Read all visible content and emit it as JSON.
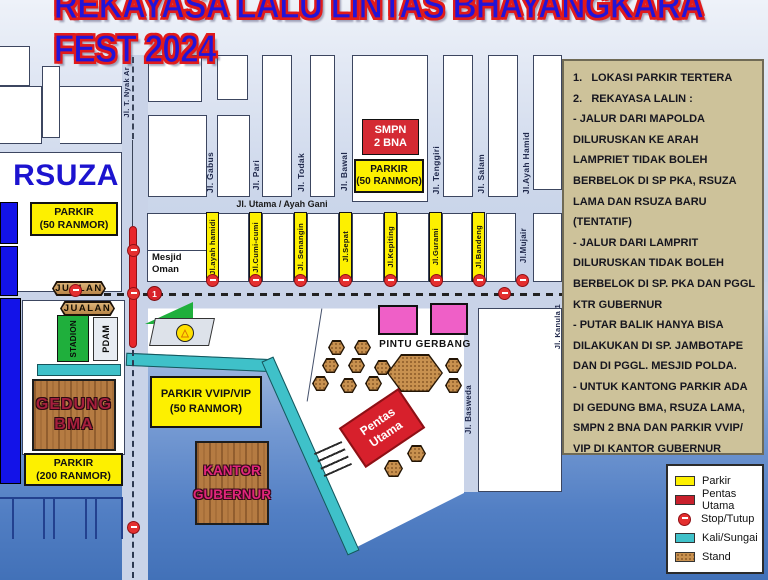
{
  "title": "REKAYASA LALU LINTAS BHAYANGKARA FEST 2024",
  "colors": {
    "title_blue": "#2214d8",
    "title_red": "#e11b1b",
    "parkir_yellow": "#fdf000",
    "pentas_red": "#d7202c",
    "kali_teal": "#3fc1c9",
    "stand_brown": "#c8914f",
    "stop_red": "#e42f2f",
    "gate_pink": "#ef5fc7"
  },
  "notes": {
    "lines": [
      "1.   LOKASI PARKIR TERTERA",
      "2.   REKAYASA LALIN :",
      "- JALUR DARI MAPOLDA",
      "DILURUSKAN KE ARAH",
      "LAMPRIET TIDAK BOLEH",
      "BERBELOK DI SP PKA, RSUZA",
      "LAMA DAN RSUZA BARU",
      "(TENTATIF)",
      "- JALUR DARI LAMPRIT",
      "DILURUSKAN TIDAK BOLEH",
      "BERBELOK DI SP. PKA DAN PGGL",
      "KTR GUBERNUR",
      "- PUTAR BALIK HANYA BISA",
      "DILAKUKAN DI SP. JAMBOTAPE",
      "DAN DI PGGL. MESJID POLDA.",
      "- UNTUK KANTONG PARKIR ADA",
      "DI GEDUNG BMA, RSUZA LAMA,",
      "SMPN 2 BNA DAN PARKIR VVIP/",
      "VIP DI KANTOR GUBERNUR"
    ]
  },
  "legend": {
    "items": [
      {
        "label": "Parkir",
        "swatch": "parkir"
      },
      {
        "label": "Pentas Utama",
        "swatch": "pentas"
      },
      {
        "label": "Stop/Tutup",
        "swatch": "stop"
      },
      {
        "label": "Kali/Sungai",
        "swatch": "kali"
      },
      {
        "label": "Stand",
        "swatch": "stand"
      }
    ]
  },
  "streets": {
    "nyak": "Jl. T. Nyak Ar",
    "gabus": "Jl. Gabus",
    "pari": "Jl. Pari",
    "todak": "Jl. Todak",
    "bawal": "Jl. Bawal",
    "tenggiri": "Jl. Tenggiri",
    "salam": "Jl. Salam",
    "ayah_hamid": "Jl.Ayah Hamid",
    "utama": "Jl. Utama / Ayah Gani",
    "ayah_hamidi": "Jl.ayah hamidi",
    "cumi": "Jl.Cumi-cumi",
    "senangin": "Jl. Senangin",
    "sepat": "Jl.Sepat",
    "kepiting": "Jl.Kepiting",
    "gurami": "Jl.Gurami",
    "bandeng": "Jl.Bandeng",
    "mujair": "Jl.Mujair",
    "basweda": "Jl. Basweda",
    "kanula": "Jl. Kanula 1"
  },
  "places": {
    "rsuza": "RSUZA",
    "mesjid_oman": [
      "Mesjid",
      "Oman"
    ],
    "smpn": [
      "SMPN",
      "2 BNA"
    ],
    "stadion": "STADION",
    "pdam": "PDAM",
    "gedung_bma": [
      "GEDUNG",
      "BMA"
    ],
    "kantor_gubernur": [
      "KANTOR",
      "GUBERNUR"
    ],
    "pintu_gerbang": "PINTU GERBANG",
    "pentas_utama": [
      "Pentas",
      "Utama"
    ],
    "jualan": "JUALAN"
  },
  "parking": {
    "rsuza": [
      "PARKIR",
      "(50 RANMOR)"
    ],
    "smpn": [
      "PARKIR",
      "(50 RANMOR)"
    ],
    "bma": [
      "PARKIR",
      "(200 RANMOR)"
    ],
    "vvip": [
      "PARKIR VVIP/VIP",
      "(50 RANMOR)"
    ]
  },
  "badges": {
    "route_1": "1"
  }
}
